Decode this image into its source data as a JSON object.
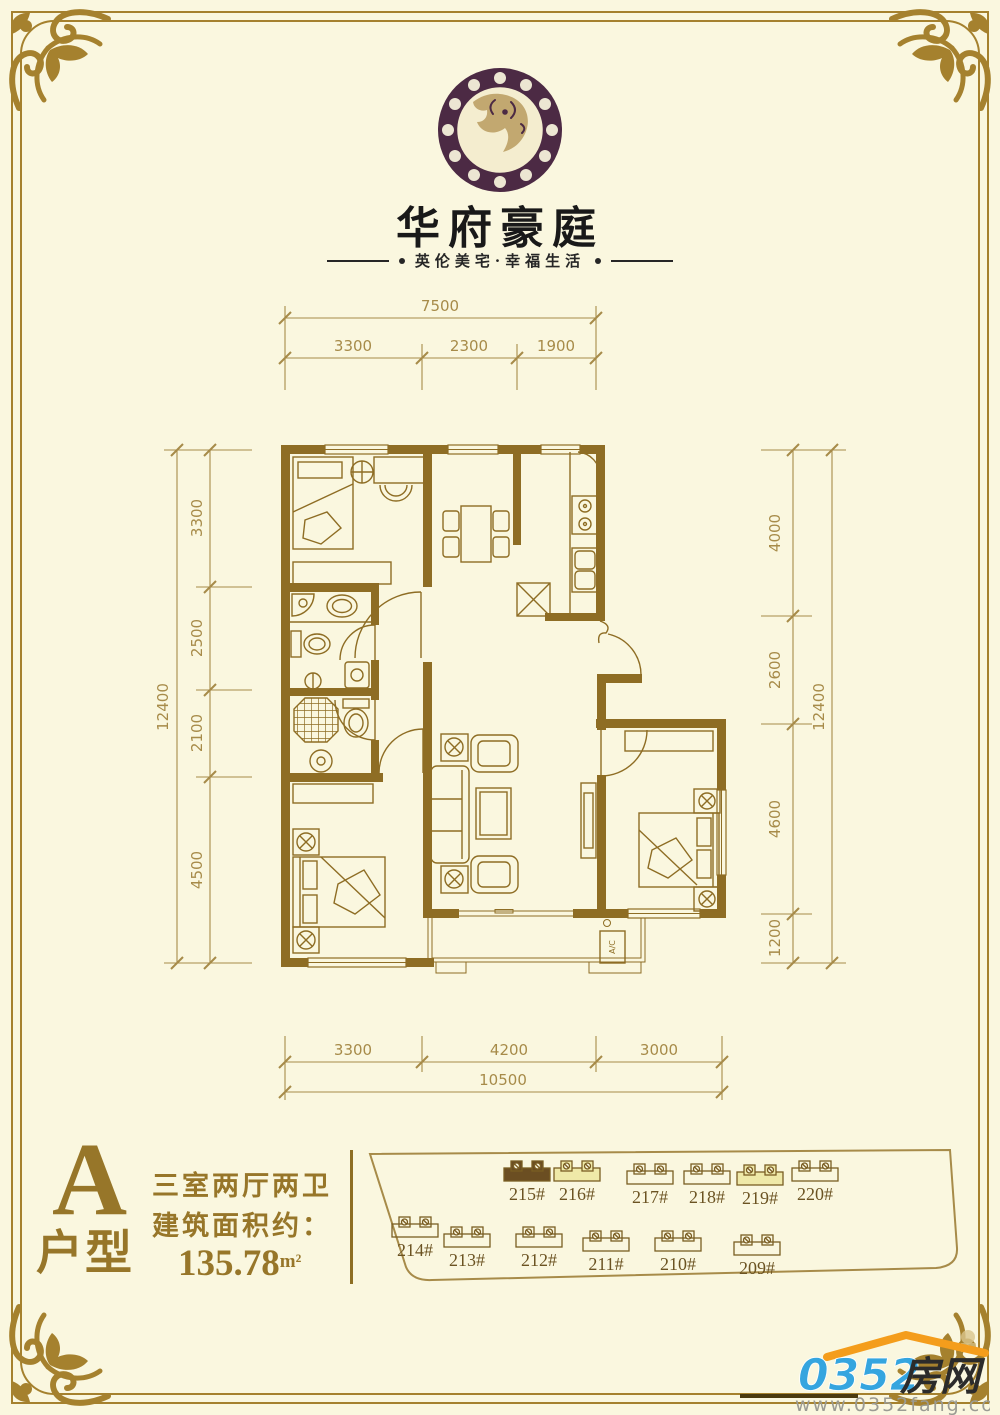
{
  "header": {
    "brand": "华府豪庭",
    "tagline": "英伦美宅·幸福生活"
  },
  "floorplan": {
    "dims": {
      "top_total": "7500",
      "top_segments": [
        "3300",
        "2300",
        "1900"
      ],
      "bottom_total": "10500",
      "bottom_segments": [
        "3300",
        "4200",
        "3000"
      ],
      "left_total": "12400",
      "left_segments": [
        "3300",
        "2500",
        "2100",
        "4500"
      ],
      "right_total": "12400",
      "right_segments": [
        "4000",
        "2600",
        "4600",
        "1200"
      ]
    },
    "labels": {
      "ac": "A/C"
    }
  },
  "unit": {
    "letter": "A",
    "word": "户型",
    "rooms": "三室两厅两卫",
    "area_label": "建筑面积约：",
    "area_value": "135.78",
    "area_unit": "m²"
  },
  "siteplan": {
    "buildings_top": [
      {
        "label": "215#",
        "style": "dark"
      },
      {
        "label": "216#",
        "style": "yellow"
      },
      {
        "label": "217#",
        "style": "plain"
      },
      {
        "label": "218#",
        "style": "plain"
      },
      {
        "label": "219#",
        "style": "yellow"
      },
      {
        "label": "220#",
        "style": "plain"
      }
    ],
    "buildings_bottom": [
      {
        "label": "214#"
      },
      {
        "label": "213#"
      },
      {
        "label": "212#"
      },
      {
        "label": "211#"
      },
      {
        "label": "210#"
      },
      {
        "label": "209#"
      }
    ]
  },
  "watermark": {
    "number": "0352",
    "word": "房网",
    "url": "www.0352fang.com"
  },
  "colors": {
    "background": "#FAF7DF",
    "frame_gold": "#A5812E",
    "wall_brown": "#8E6D24",
    "dim_tan": "#A78B49",
    "accent_gold": "#977629",
    "logo_plum": "#4C2A44",
    "logo_tan": "#C2A870",
    "site_dark": "#6B4E22",
    "site_yellow": "#EFE9A8",
    "wm_blue": "#35A5DF",
    "wm_orange": "#F49D1C"
  }
}
